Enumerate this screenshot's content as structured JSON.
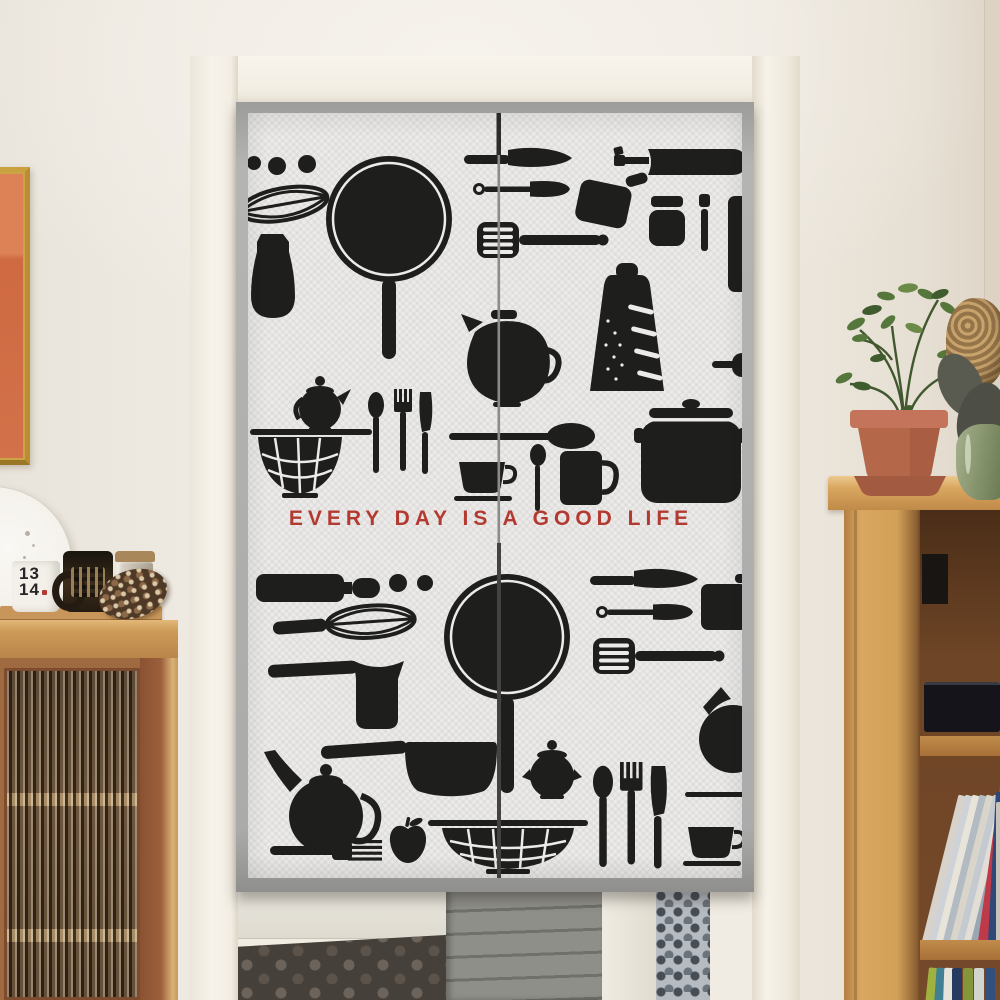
{
  "scene": {
    "type": "product photograph",
    "description": "Japanese noren doorway curtain printed with black kitchen-utensil silhouettes, hung inside a cream door frame; a glass-front wooden cabinet stands to the left and an oak bookshelf with a potted plant to the right, with a kitchen floor visible below the curtain."
  },
  "curtain": {
    "slogan": "EVERY DAY IS A GOOD LIFE",
    "slogan_color": "#b23a31",
    "fabric_color": "#ecebe9",
    "border_color": "#ababab",
    "silhouette_color": "#1e1e1c",
    "panel_count": 2,
    "motifs_top_panel": [
      "dots",
      "whisk",
      "pitcher",
      "frying-pan",
      "table-knife",
      "spatula",
      "slotted-turner",
      "flipper",
      "wine-bottle",
      "jar",
      "shaker",
      "cutting-board",
      "coffee-pot",
      "grater",
      "serving-board",
      "teapot",
      "colander",
      "spoon",
      "fork",
      "knife",
      "long-spoon",
      "teaspoon",
      "teacup-and-saucer",
      "mug",
      "lidded-pot"
    ],
    "motifs_bottom_panel": [
      "rolling-pin",
      "dots",
      "whisk",
      "frying-pan",
      "table-knife",
      "spatula",
      "flipper",
      "slotted-turner",
      "cezve",
      "pitcher",
      "saucepan",
      "teapot",
      "sugar-pot",
      "apple",
      "fork",
      "colander",
      "spoon",
      "fork",
      "knife",
      "chopstick",
      "teacup-and-saucer"
    ]
  },
  "cabinet": {
    "mug_label_line1": "13",
    "mug_label_line2": "14",
    "items_on_top": [
      "white mug",
      "dark patterned mug",
      "lidded glass jar",
      "pinecone",
      "wooden tray"
    ],
    "door_style": "fluted glass"
  },
  "bookshelf": {
    "items": [
      "black box",
      "black speaker",
      "leaning books",
      "upright books"
    ],
    "lean_spine_colors": [
      "#d7d3ca",
      "#cfd3d8",
      "#e8e4da",
      "#b2bac2",
      "#dad5cb",
      "#c4cad0",
      "#e2ded6",
      "#9aa6b2",
      "#bf3a48",
      "#2f4878",
      "#c8c4ba"
    ],
    "bottom_spine_colors": [
      "#9fb23f",
      "#417f92",
      "#e6e3da",
      "#253a5e",
      "#87953a",
      "#d2d5cf",
      "#31507e"
    ]
  },
  "decor": {
    "wall_art": "gold-framed orange artwork",
    "plate": "white decorative plate",
    "plant": "green plant in terracotta pot",
    "vase": "green vase with dried flowers"
  },
  "palette": {
    "wall": "#ece7df",
    "door_frame": "#f6f2e9",
    "cabinet_wood": "#c08a4c",
    "bookshelf_wood": "#d9a75f",
    "kitchen_floor": "#45403a",
    "terracotta_pot": "#b5674a",
    "accent_red": "#b23a31"
  }
}
